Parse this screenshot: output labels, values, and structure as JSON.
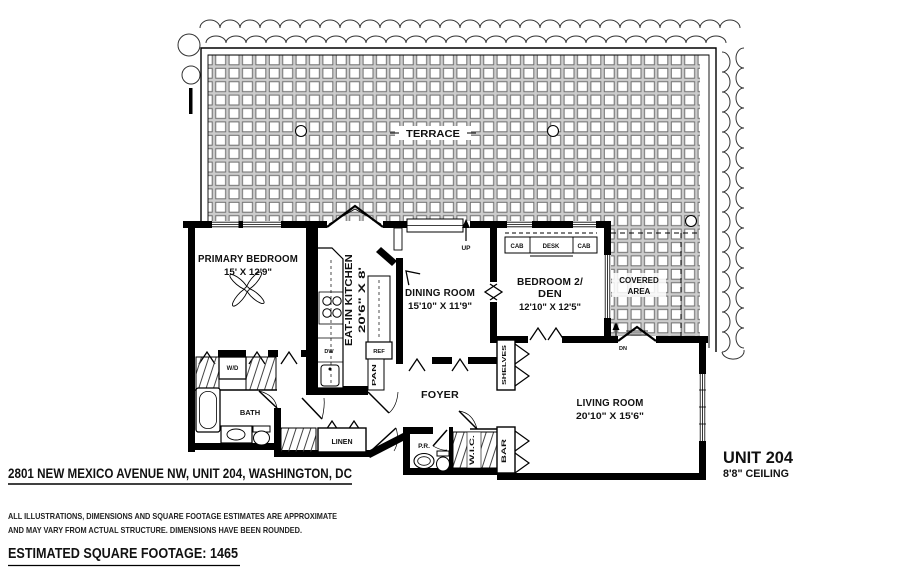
{
  "plan": {
    "terrace": {
      "label": "TERRACE"
    },
    "covered_area": {
      "line1": "COVERED",
      "line2": "AREA"
    },
    "rooms": {
      "primary_bedroom": {
        "name": "PRIMARY BEDROOM",
        "dims": "15' X 12'9\""
      },
      "eat_in_kitchen": {
        "name": "EAT-IN KITCHEN",
        "dims": "20'6\" X 8'"
      },
      "dining_room": {
        "name": "DINING ROOM",
        "dims": "15'10\" X 11'9\""
      },
      "bedroom2_den": {
        "name_line1": "BEDROOM 2/",
        "name_line2": "DEN",
        "dims": "12'10\" X 12'5\""
      },
      "living_room": {
        "name": "LIVING ROOM",
        "dims": "20'10\" X 15'6\""
      },
      "foyer": {
        "name": "FOYER"
      },
      "bath": {
        "name": "BATH"
      }
    },
    "fixtures": {
      "wd": "W/D",
      "linen": "LINEN",
      "pr": "P.R.",
      "wic": "W.I.C.",
      "bar": "BAR",
      "shelves": "SHELVES",
      "cab_left": "CAB",
      "desk": "DESK",
      "cab_right": "CAB",
      "ref": "REF",
      "pan": "PAN",
      "dw": "DW",
      "up": "UP",
      "dn": "DN"
    }
  },
  "annotations": {
    "address": "2801 NEW MEXICO AVENUE NW, UNIT 204, WASHINGTON, DC",
    "disclaimer_line1": "ALL ILLUSTRATIONS, DIMENSIONS AND SQUARE FOOTAGE ESTIMATES ARE APPROXIMATE",
    "disclaimer_line2": "AND MAY VARY FROM ACTUAL STRUCTURE. DIMENSIONS HAVE BEEN ROUNDED.",
    "square_footage": "ESTIMATED SQUARE FOOTAGE: 1465",
    "unit_label": "UNIT 204",
    "ceiling": "8'8\" CEILING"
  },
  "colors": {
    "ink": "#111111",
    "wall": "#000000",
    "tile_grout": "#cccccc",
    "tile_edge": "#6e6e6e"
  }
}
